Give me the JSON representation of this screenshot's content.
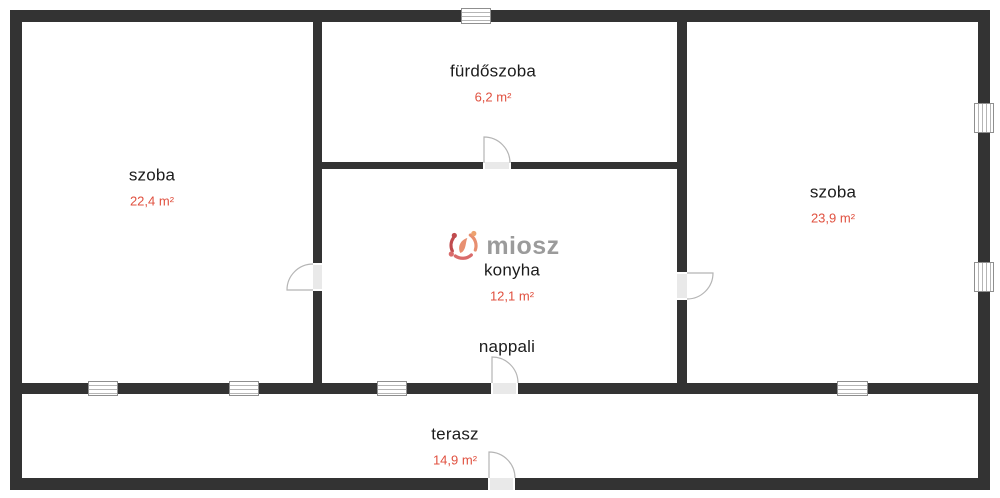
{
  "plan": {
    "type": "floor-plan",
    "language": "hu"
  },
  "rooms": [
    {
      "id": "szoba-left",
      "label": "szoba",
      "area": "22,4 m²"
    },
    {
      "id": "furdoszoba",
      "label": "fürdőszoba",
      "area": "6,2 m²"
    },
    {
      "id": "konyha",
      "label": "konyha",
      "area": "12,1 m²"
    },
    {
      "id": "szoba-right",
      "label": "szoba",
      "area": "23,9 m²"
    },
    {
      "id": "nappali",
      "label": "nappali",
      "area": ""
    },
    {
      "id": "terasz",
      "label": "terasz",
      "area": "14,9 m²"
    }
  ],
  "watermark": {
    "text": "miosz"
  },
  "colors": {
    "wall": "#333333",
    "room_label": "#1c1c1c",
    "area_label": "#e0503f",
    "logo_text": "#9b9b9b",
    "logo_mark_dark": "#c04b4e",
    "logo_mark_light": "#e88f70",
    "door_line": "#b5b5b5"
  },
  "counts": {
    "windows": 7,
    "doors": 5
  }
}
